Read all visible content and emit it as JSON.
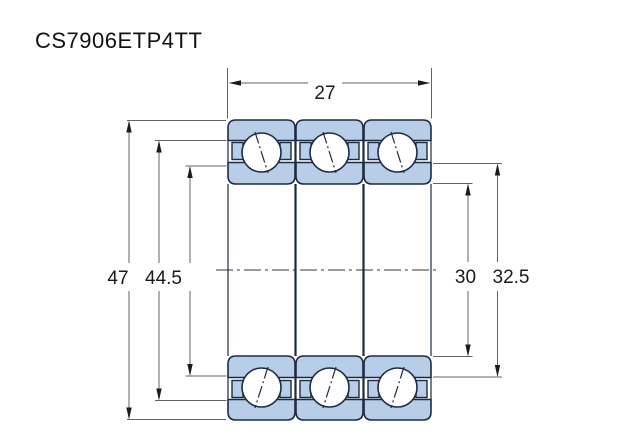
{
  "title": "CS7906ETP4TT",
  "drawing": {
    "subject": "triple-stacked angular contact ball bearing cross-section",
    "dim_width": "27",
    "dim_outer_diameter": "47",
    "dim_outer_shoulder": "44.5",
    "dim_bore": "30",
    "dim_inner_shoulder": "32.5",
    "colors": {
      "ring_fill": "#b8cee8",
      "outline": "#1d2a44",
      "dimension_line": "#5f6368",
      "label_text": "#1a1a1a"
    }
  }
}
